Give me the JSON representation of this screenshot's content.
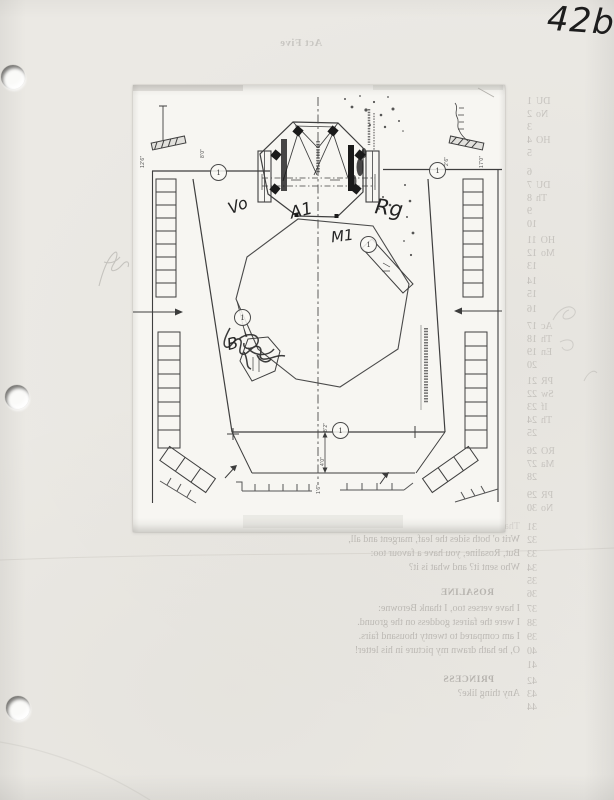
{
  "page": {
    "handwritten_page_number": "42b"
  },
  "bleedthrough": {
    "act_header": "Act Five",
    "line_numbers": [
      {
        "n": "1",
        "y": 101,
        "frag": "DU"
      },
      {
        "n": "2",
        "y": 114,
        "frag": "No"
      },
      {
        "n": "3",
        "y": 127,
        "frag": ""
      },
      {
        "n": "4",
        "y": 140,
        "frag": "HO"
      },
      {
        "n": "5",
        "y": 153,
        "frag": ""
      },
      {
        "n": "6",
        "y": 172,
        "frag": ""
      },
      {
        "n": "7",
        "y": 185,
        "frag": "DU"
      },
      {
        "n": "8",
        "y": 198,
        "frag": "Th"
      },
      {
        "n": "9",
        "y": 211,
        "frag": ""
      },
      {
        "n": "10",
        "y": 224,
        "frag": ""
      },
      {
        "n": "11",
        "y": 240,
        "frag": "HO"
      },
      {
        "n": "12",
        "y": 253,
        "frag": "Mo"
      },
      {
        "n": "13",
        "y": 266,
        "frag": ""
      },
      {
        "n": "14",
        "y": 281,
        "frag": ""
      },
      {
        "n": "15",
        "y": 294,
        "frag": ""
      },
      {
        "n": "16",
        "y": 309,
        "frag": ""
      },
      {
        "n": "17",
        "y": 326,
        "frag": "Ac"
      },
      {
        "n": "18",
        "y": 339,
        "frag": "Th"
      },
      {
        "n": "19",
        "y": 352,
        "frag": "En"
      },
      {
        "n": "20",
        "y": 365,
        "frag": ""
      },
      {
        "n": "21",
        "y": 381,
        "frag": "PR"
      },
      {
        "n": "22",
        "y": 394,
        "frag": "Sw"
      },
      {
        "n": "23",
        "y": 407,
        "frag": "If"
      },
      {
        "n": "24",
        "y": 420,
        "frag": "Th"
      },
      {
        "n": "25",
        "y": 433,
        "frag": ""
      },
      {
        "n": "26",
        "y": 451,
        "frag": "RO"
      },
      {
        "n": "27",
        "y": 464,
        "frag": "Ma"
      },
      {
        "n": "28",
        "y": 477,
        "frag": ""
      },
      {
        "n": "29",
        "y": 495,
        "frag": "PR"
      },
      {
        "n": "30",
        "y": 508,
        "frag": "No"
      },
      {
        "n": "31",
        "y": 527,
        "frag": ""
      },
      {
        "n": "32",
        "y": 540,
        "frag": ""
      },
      {
        "n": "33",
        "y": 554,
        "frag": ""
      },
      {
        "n": "34",
        "y": 568,
        "frag": ""
      },
      {
        "n": "35",
        "y": 581,
        "frag": ""
      },
      {
        "n": "36",
        "y": 594,
        "frag": ""
      },
      {
        "n": "37",
        "y": 609,
        "frag": ""
      },
      {
        "n": "38",
        "y": 623,
        "frag": ""
      },
      {
        "n": "39",
        "y": 637,
        "frag": ""
      },
      {
        "n": "40",
        "y": 651,
        "frag": ""
      },
      {
        "n": "41",
        "y": 665,
        "frag": ""
      },
      {
        "n": "42",
        "y": 681,
        "frag": ""
      },
      {
        "n": "43",
        "y": 694,
        "frag": ""
      },
      {
        "n": "44",
        "y": 707,
        "frag": ""
      }
    ],
    "script_lines": [
      {
        "y": 527,
        "text": "That he was fain to seal on Cupid's name.",
        "cls": "xfaint"
      },
      {
        "y": 540,
        "text": "Writ o' both sides the leaf, margent and all,"
      },
      {
        "y": 554,
        "text": "But, Rosaline, you have a favour too:"
      },
      {
        "y": 568,
        "text": "Who sent it? and what is it?"
      },
      {
        "y": 594,
        "text": "ROSALINE",
        "cls": "speaker"
      },
      {
        "y": 609,
        "text": "I have verses too, I thank Berowne:"
      },
      {
        "y": 623,
        "text": "I were the fairest goddess on the ground."
      },
      {
        "y": 637,
        "text": "I am compared to twenty thousand fairs."
      },
      {
        "y": 651,
        "text": "O, he hath drawn my picture in his letter!"
      },
      {
        "y": 681,
        "text": "PRINCESS",
        "cls": "speaker"
      },
      {
        "y": 694,
        "text": "Any thing like?"
      }
    ]
  },
  "diagram": {
    "handwritten_labels": [
      {
        "text": "Vo",
        "x": 228,
        "y": 196,
        "rot": -22,
        "size": 16
      },
      {
        "text": "A1",
        "x": 290,
        "y": 201,
        "rot": -14,
        "size": 17
      },
      {
        "text": "Rg",
        "x": 375,
        "y": 196,
        "rot": 8,
        "size": 21
      },
      {
        "text": "M1",
        "x": 331,
        "y": 227,
        "rot": -7,
        "size": 15
      },
      {
        "text": "B",
        "x": 227,
        "y": 334,
        "rot": -14,
        "size": 16
      }
    ],
    "circled_markers": [
      {
        "label": "1",
        "x": 218,
        "y": 172
      },
      {
        "label": "1",
        "x": 437,
        "y": 170
      },
      {
        "label": "1",
        "x": 368,
        "y": 244
      },
      {
        "label": "1",
        "x": 242,
        "y": 317
      },
      {
        "label": "1",
        "x": 340,
        "y": 430
      }
    ],
    "dimension_labels": [
      {
        "text": "8'0\"",
        "x": 200,
        "y": 158
      },
      {
        "text": "12'6\"",
        "x": 140,
        "y": 168
      },
      {
        "text": "2'6\"",
        "x": 444,
        "y": 166
      },
      {
        "text": "17'0\"",
        "x": 479,
        "y": 168
      },
      {
        "text": "8'2\"",
        "x": 323,
        "y": 432
      },
      {
        "text": "4'0\"",
        "x": 320,
        "y": 466
      },
      {
        "text": "1'6\"",
        "x": 316,
        "y": 494
      }
    ]
  }
}
